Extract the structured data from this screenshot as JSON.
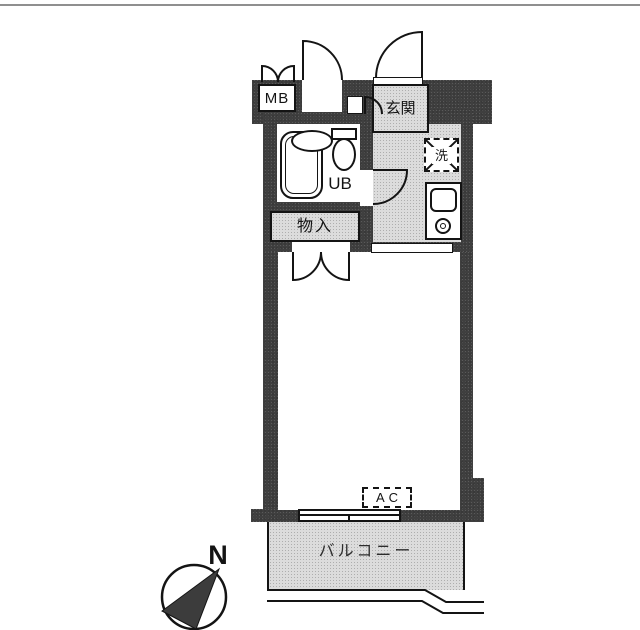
{
  "colors": {
    "wall": "#3f3f3f",
    "floor_gray": "#dcdcdc",
    "line": "#141414",
    "top_rule": "#8f8f8f"
  },
  "labels": {
    "meter_box": "MB",
    "entrance": "玄関",
    "washer": "洗",
    "unit_bath": "UB",
    "storage": "物入",
    "air_conditioner": "AC",
    "balcony": "バルコニー",
    "north": "N"
  }
}
